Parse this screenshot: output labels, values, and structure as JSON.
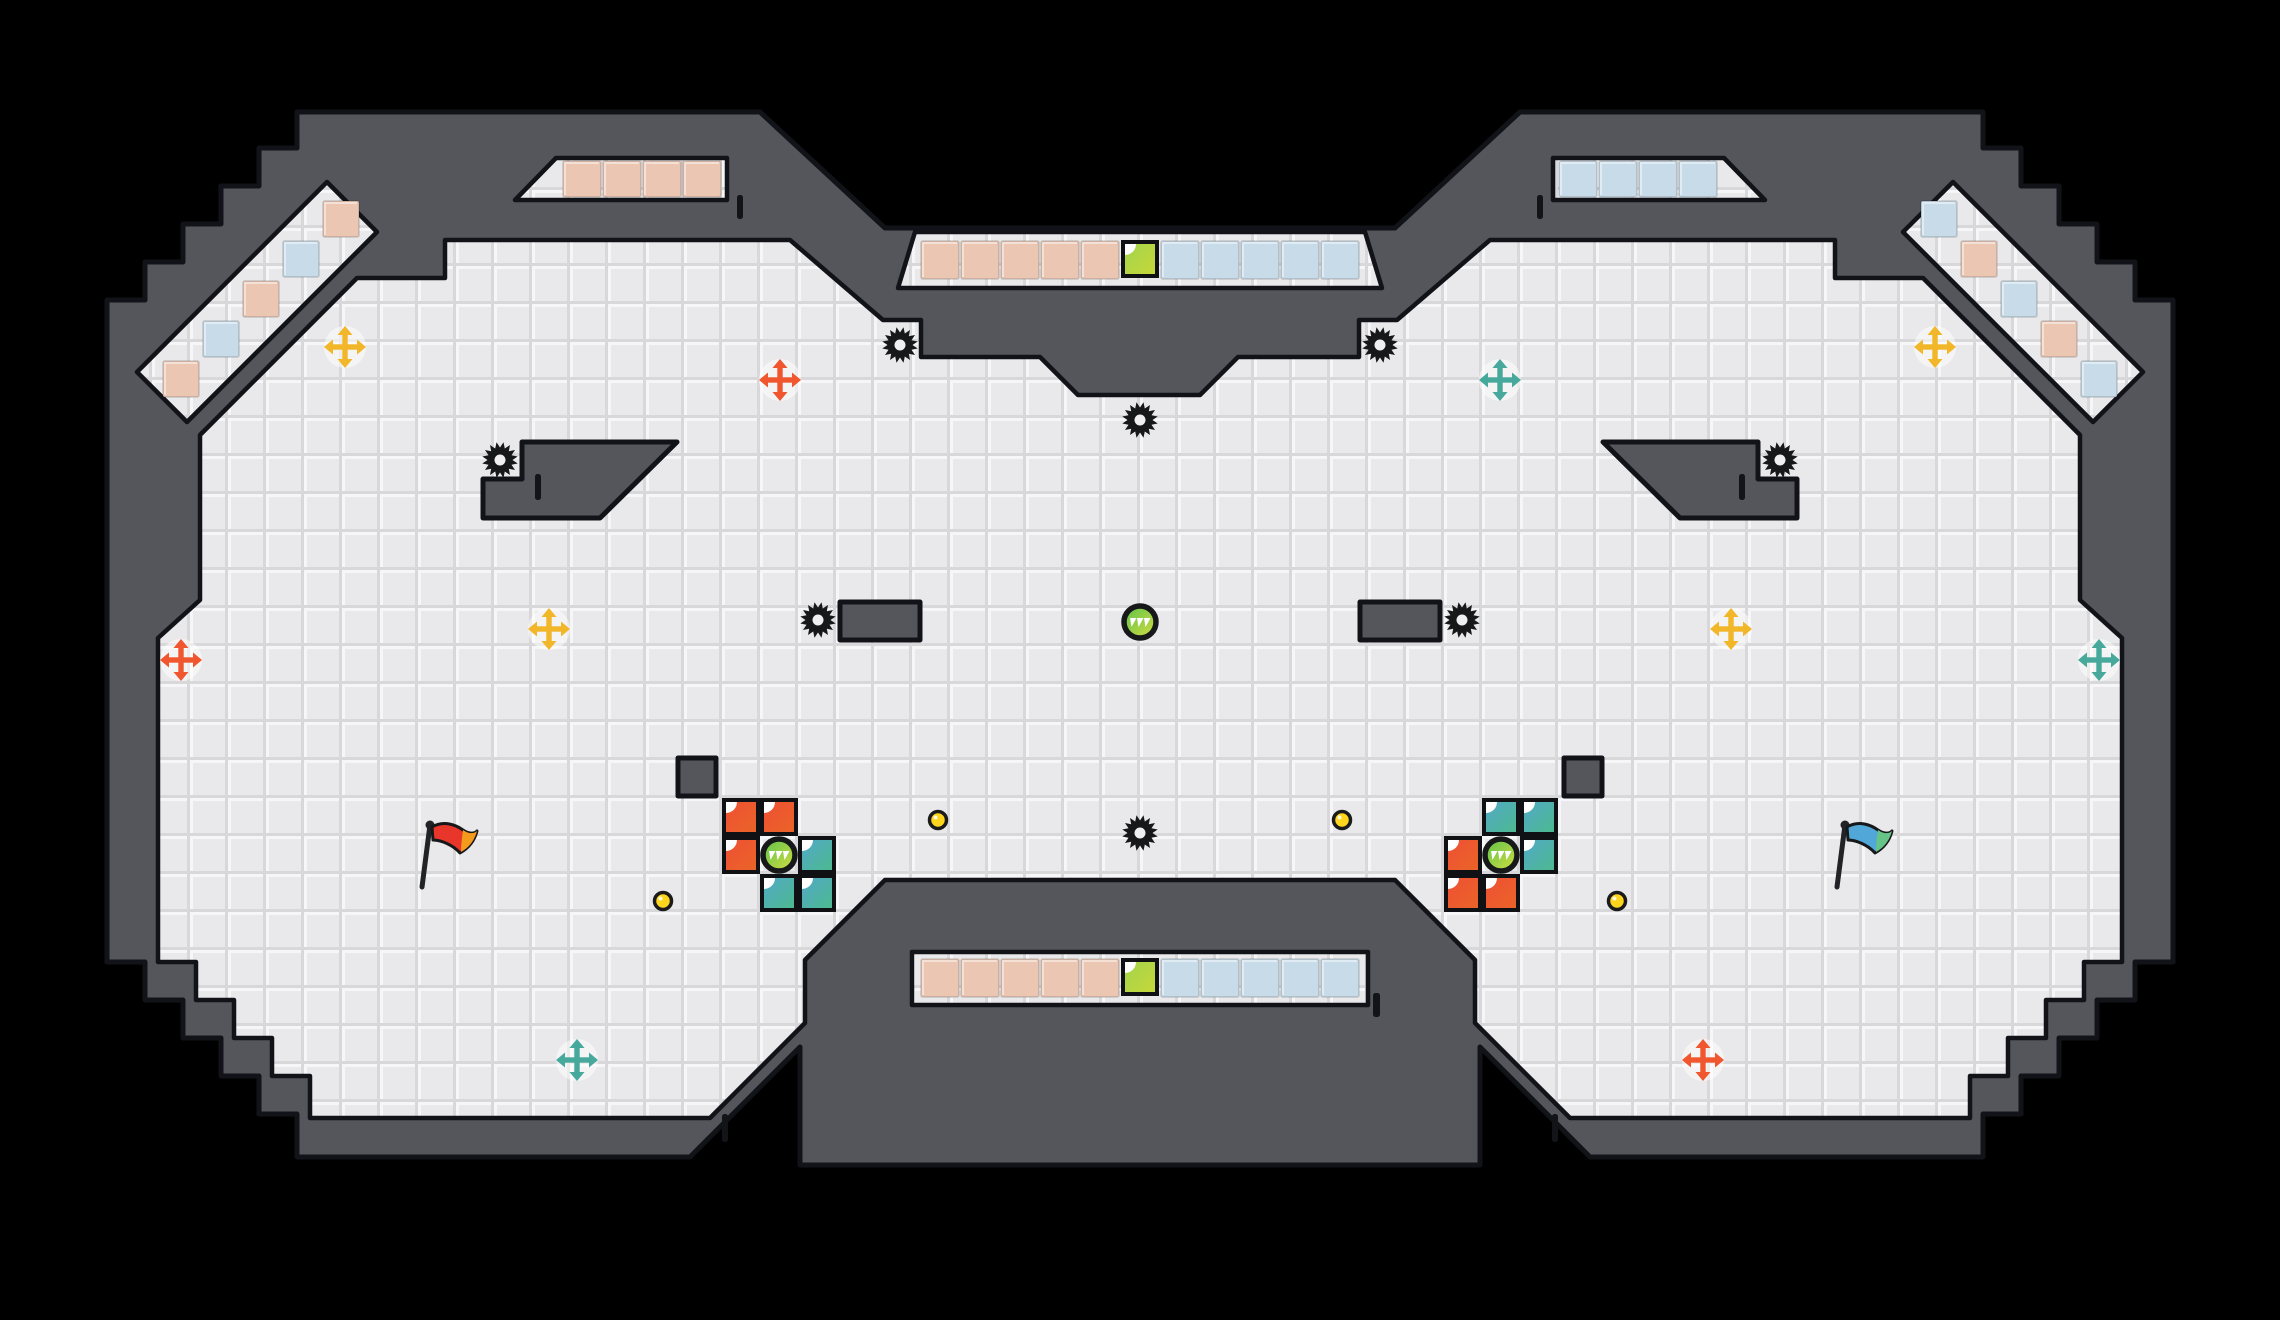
{
  "app": {
    "name": "ctf-arena-map-viewer",
    "visible_text": []
  },
  "canvas": {
    "width": 2280,
    "height": 1320,
    "background": "#000000"
  },
  "palette": {
    "wall": "#55565c",
    "wall_outline": "#121318",
    "floor": "#e9e9eb",
    "floor_bevel_light": "#f6f6f8",
    "floor_bevel_dark": "#d8d8db",
    "team_red_tile": "#ebc7b3",
    "team_blue_tile": "#c7dbe9",
    "gate_red": [
      "#ef4f36",
      "#ea6526"
    ],
    "gate_teal": [
      "#53a8cb",
      "#4cba8c"
    ],
    "gate_green": [
      "#a0d44e",
      "#c8d838"
    ],
    "powerup": [
      "#5cc24b",
      "#d4dd41"
    ],
    "boost_yellow": "#f2b629",
    "boost_orange": "#f0572f",
    "boost_teal": "#47a99c",
    "gold": "#ffd61e",
    "spike": "#17181a",
    "spike_center": "#f0f0f2",
    "flag_red": [
      "#e8362a",
      "#f49a1c"
    ],
    "flag_blue": [
      "#51a8d8",
      "#67c487"
    ],
    "tick": "#131418"
  },
  "map": {
    "silhouette": "107,300 145,300 145,262 183,262 183,224 221,224 221,186 259,186 259,148 297,148 297,112 760,112 885,228 1395,228 1520,112 1983,112 1983,148 2021,148 2021,186 2059,186 2059,224 2097,224 2097,262 2135,262 2135,300 2173,300 2173,962 2135,962 2135,1000 2097,1000 2097,1038 2059,1038 2059,1076 2021,1076 2021,1114 1983,1114 1983,1157 1590,1157 1480,1047 1480,1165 800,1165 800,1047 690,1157 297,1157 297,1114 259,1114 259,1076 221,1076 221,1038 183,1038 183,1000 145,1000 145,962 107,962",
    "floors": [
      {
        "name": "main-floor",
        "points": "357,278 445,278 445,240 790,240 883,320 921,320 921,357 1040,357 1078,395 1200,395 1238,357 1359,357 1359,320 1397,320 1490,240 1835,240 1835,278 1923,278 2080,435 2080,600 2122,638 2122,962 2084,962 2084,1000 2046,1000 2046,1038 2008,1038 2008,1076 1970,1076 1970,1118 1570,1118 1475,1023 1475,960 1395,880 885,880 805,960 805,1023 710,1118 310,1118 310,1076 272,1076 272,1038 234,1038 234,1000 196,1000 196,962 158,962 158,638 200,600 200,435"
      },
      {
        "name": "corridor-top-left",
        "points": "327,182 377,232 187,422 137,372"
      },
      {
        "name": "corridor-top-right",
        "points": "1953,182 1903,232 2093,422 2143,372"
      },
      {
        "name": "slot-top-left",
        "points": "515,200 556,158 727,158 727,200"
      },
      {
        "name": "slot-top-right",
        "points": "1765,200 1724,158 1553,158 1553,200"
      },
      {
        "name": "banner-recess-top",
        "points": "915,232 1365,232 1382,288 898,288"
      },
      {
        "name": "banner-recess-bottom",
        "points": "912,952 1368,952 1368,1005 912,1005"
      }
    ],
    "islands": [
      {
        "name": "wedge-left",
        "points": "522,442 677,442 600,518 483,518 483,479 522,479"
      },
      {
        "name": "wedge-right",
        "points": "1758,442 1603,442 1680,518 1797,518 1797,479 1758,479"
      },
      {
        "name": "block-left",
        "points": "840,602 920,602 920,640 840,640"
      },
      {
        "name": "block-right",
        "points": "1360,602 1440,602 1440,640 1360,640"
      },
      {
        "name": "cube-left",
        "points": "678,758 716,758 716,796 678,796"
      },
      {
        "name": "cube-right",
        "points": "1564,758 1602,758 1602,796 1564,796"
      }
    ]
  },
  "team_tiles": [
    {
      "x": 322,
      "y": 200,
      "w": 38,
      "h": 38,
      "team": "red"
    },
    {
      "x": 282,
      "y": 240,
      "w": 38,
      "h": 38,
      "team": "blue"
    },
    {
      "x": 242,
      "y": 280,
      "w": 38,
      "h": 38,
      "team": "red"
    },
    {
      "x": 202,
      "y": 320,
      "w": 38,
      "h": 38,
      "team": "blue"
    },
    {
      "x": 162,
      "y": 360,
      "w": 38,
      "h": 38,
      "team": "red"
    },
    {
      "x": 1920,
      "y": 200,
      "w": 38,
      "h": 38,
      "team": "blue"
    },
    {
      "x": 1960,
      "y": 240,
      "w": 38,
      "h": 38,
      "team": "red"
    },
    {
      "x": 2000,
      "y": 280,
      "w": 38,
      "h": 38,
      "team": "blue"
    },
    {
      "x": 2040,
      "y": 320,
      "w": 38,
      "h": 38,
      "team": "red"
    },
    {
      "x": 2080,
      "y": 360,
      "w": 38,
      "h": 38,
      "team": "blue"
    },
    {
      "x": 562,
      "y": 160,
      "w": 40,
      "h": 38,
      "team": "red"
    },
    {
      "x": 602,
      "y": 160,
      "w": 40,
      "h": 38,
      "team": "red"
    },
    {
      "x": 642,
      "y": 160,
      "w": 40,
      "h": 38,
      "team": "red"
    },
    {
      "x": 682,
      "y": 160,
      "w": 40,
      "h": 38,
      "team": "red"
    },
    {
      "x": 1558,
      "y": 160,
      "w": 40,
      "h": 38,
      "team": "blue"
    },
    {
      "x": 1598,
      "y": 160,
      "w": 40,
      "h": 38,
      "team": "blue"
    },
    {
      "x": 1638,
      "y": 160,
      "w": 40,
      "h": 38,
      "team": "blue"
    },
    {
      "x": 1678,
      "y": 160,
      "w": 40,
      "h": 38,
      "team": "blue"
    }
  ],
  "banners": [
    {
      "name": "banner-top",
      "y": 240,
      "h": 40,
      "red_x": [
        920,
        960,
        1000,
        1040,
        1080
      ],
      "gate_x": 1120,
      "blue_x": [
        1160,
        1200,
        1240,
        1280,
        1320
      ],
      "tile_w": 40
    },
    {
      "name": "banner-bottom",
      "y": 958,
      "h": 40,
      "red_x": [
        920,
        960,
        1000,
        1040,
        1080
      ],
      "gate_x": 1120,
      "blue_x": [
        1160,
        1200,
        1240,
        1280,
        1320
      ],
      "tile_w": 40
    }
  ],
  "items": {
    "spikes": [
      {
        "x": 900,
        "y": 345
      },
      {
        "x": 1380,
        "y": 345
      },
      {
        "x": 1140,
        "y": 420
      },
      {
        "x": 500,
        "y": 460
      },
      {
        "x": 1780,
        "y": 460
      },
      {
        "x": 818,
        "y": 620
      },
      {
        "x": 1462,
        "y": 620
      },
      {
        "x": 1140,
        "y": 833
      }
    ],
    "boosts": [
      {
        "x": 345,
        "y": 347,
        "color": "yellow"
      },
      {
        "x": 1935,
        "y": 347,
        "color": "yellow"
      },
      {
        "x": 549,
        "y": 629,
        "color": "yellow"
      },
      {
        "x": 1731,
        "y": 629,
        "color": "yellow"
      },
      {
        "x": 780,
        "y": 380,
        "color": "orange"
      },
      {
        "x": 1500,
        "y": 380,
        "color": "teal"
      },
      {
        "x": 181,
        "y": 660,
        "color": "orange"
      },
      {
        "x": 2099,
        "y": 660,
        "color": "teal"
      },
      {
        "x": 577,
        "y": 1060,
        "color": "teal"
      },
      {
        "x": 1703,
        "y": 1060,
        "color": "orange"
      }
    ],
    "powerups": [
      {
        "x": 779,
        "y": 855
      },
      {
        "x": 1501,
        "y": 855
      },
      {
        "x": 1140,
        "y": 622
      }
    ],
    "gold": [
      {
        "x": 938,
        "y": 820
      },
      {
        "x": 1342,
        "y": 820
      },
      {
        "x": 663,
        "y": 901
      },
      {
        "x": 1617,
        "y": 901
      }
    ],
    "gates": [
      {
        "x": 722,
        "y": 798,
        "team": "red"
      },
      {
        "x": 760,
        "y": 798,
        "team": "red"
      },
      {
        "x": 722,
        "y": 836,
        "team": "red"
      },
      {
        "x": 798,
        "y": 836,
        "team": "teal"
      },
      {
        "x": 760,
        "y": 874,
        "team": "teal"
      },
      {
        "x": 798,
        "y": 874,
        "team": "teal"
      },
      {
        "x": 1482,
        "y": 798,
        "team": "teal"
      },
      {
        "x": 1520,
        "y": 798,
        "team": "teal"
      },
      {
        "x": 1520,
        "y": 836,
        "team": "teal"
      },
      {
        "x": 1444,
        "y": 836,
        "team": "red"
      },
      {
        "x": 1444,
        "y": 874,
        "team": "red"
      },
      {
        "x": 1482,
        "y": 874,
        "team": "red"
      }
    ],
    "flags": [
      {
        "x": 430,
        "y": 855,
        "team": "red"
      },
      {
        "x": 1845,
        "y": 855,
        "team": "blue"
      }
    ],
    "ticks": [
      {
        "x": 737,
        "y": 195,
        "w": 6,
        "h": 24
      },
      {
        "x": 1537,
        "y": 195,
        "w": 6,
        "h": 24
      },
      {
        "x": 535,
        "y": 474,
        "w": 6,
        "h": 26
      },
      {
        "x": 1739,
        "y": 474,
        "w": 6,
        "h": 26
      },
      {
        "x": 722,
        "y": 1114,
        "w": 6,
        "h": 28
      },
      {
        "x": 1552,
        "y": 1114,
        "w": 6,
        "h": 28
      },
      {
        "x": 1373,
        "y": 993,
        "w": 7,
        "h": 24
      }
    ]
  }
}
